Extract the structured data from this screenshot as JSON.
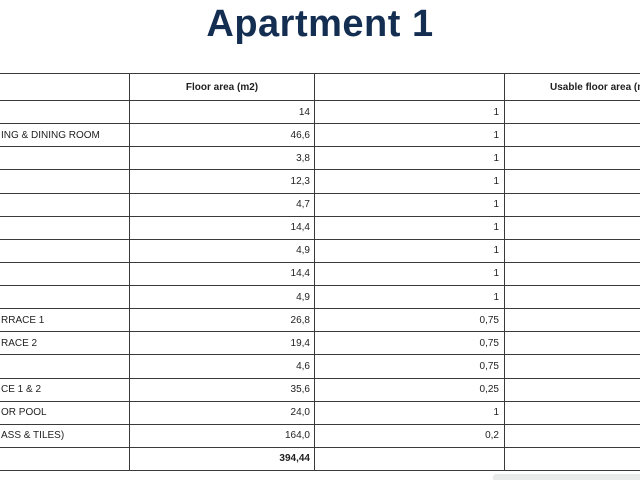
{
  "title": "Apartment 1",
  "colors": {
    "title_text": "#142e52",
    "table_border": "#3a3a3a",
    "body_text": "#1f1f1f",
    "scrollbar": "#e9ebeb"
  },
  "table": {
    "headers": [
      "",
      "Floor area (m2)",
      "",
      "Usable floor area (m"
    ],
    "rows": [
      {
        "cells": [
          "",
          "14",
          "1",
          ""
        ]
      },
      {
        "cells": [
          "ING & DINING ROOM",
          "46,6",
          "1",
          ""
        ]
      },
      {
        "cells": [
          "",
          "3,8",
          "1",
          ""
        ]
      },
      {
        "cells": [
          "",
          "12,3",
          "1",
          ""
        ]
      },
      {
        "cells": [
          "",
          "4,7",
          "1",
          ""
        ]
      },
      {
        "cells": [
          "",
          "14,4",
          "1",
          ""
        ]
      },
      {
        "cells": [
          "",
          "4,9",
          "1",
          ""
        ]
      },
      {
        "cells": [
          "",
          "14,4",
          "1",
          ""
        ]
      },
      {
        "cells": [
          "",
          "4,9",
          "1",
          ""
        ]
      },
      {
        "cells": [
          "RRACE 1",
          "26,8",
          "0,75",
          ""
        ]
      },
      {
        "cells": [
          "RACE 2",
          "19,4",
          "0,75",
          ""
        ]
      },
      {
        "cells": [
          "",
          "4,6",
          "0,75",
          ""
        ]
      },
      {
        "cells": [
          "CE 1 & 2",
          "35,6",
          "0,25",
          ""
        ]
      },
      {
        "cells": [
          "OR POOL",
          "24,0",
          "1",
          ""
        ]
      },
      {
        "cells": [
          "ASS & TILES)",
          "164,0",
          "0,2",
          ""
        ]
      },
      {
        "cells": [
          "",
          "394,44",
          "",
          ""
        ],
        "bold": true,
        "total": true
      }
    ]
  }
}
